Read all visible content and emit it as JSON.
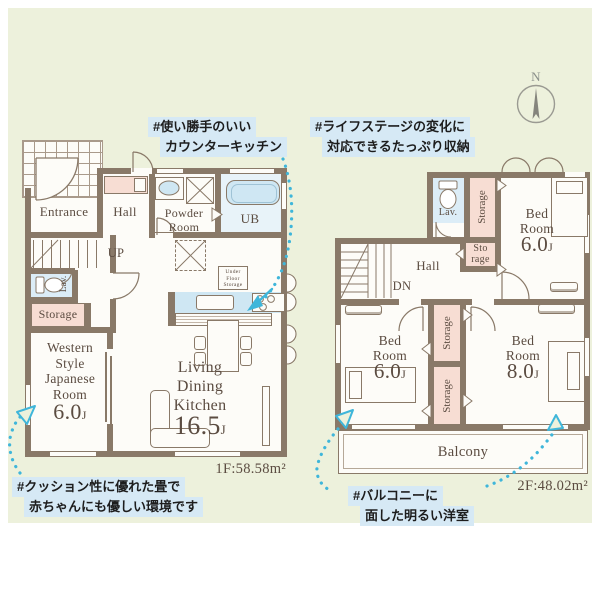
{
  "compass": {
    "label": "N"
  },
  "annotations": {
    "kitchen": [
      "#使い勝手のいい",
      "カウンターキッチン"
    ],
    "storage": [
      "#ライフステージの変化に",
      "対応できるたっぷり収納"
    ],
    "tatami": [
      "#クッション性に優れた畳で",
      "赤ちゃんにも優しい環境です"
    ],
    "balcony": [
      "#バルコニーに",
      "面した明るい洋室"
    ]
  },
  "floor1": {
    "area_label": "1F:58.58m²",
    "rooms": {
      "entrance": "Entrance",
      "hall": "Hall",
      "powder": [
        "Powder",
        "Room"
      ],
      "bath": "UB",
      "stairs": "UP",
      "lavatory": "Lav.",
      "storage": "Storage",
      "under_floor": "Under Floor Storage",
      "japanese": {
        "l1": "Western",
        "l2": "Style",
        "l3": "Japanese",
        "l4": "Room",
        "size": "6.0",
        "unit": "J"
      },
      "ldk": {
        "l1": "Living",
        "l2": "Dining",
        "l3": "Kitchen",
        "size": "16.5",
        "unit": "J"
      }
    }
  },
  "floor2": {
    "area_label": "2F:48.02m²",
    "rooms": {
      "lavatory": "Lav.",
      "storage_top": "Storage",
      "storage_small": [
        "Sto",
        "rage"
      ],
      "hall": "Hall",
      "stairs": "DN",
      "bed_top": {
        "l1": "Bed",
        "l2": "Room",
        "size": "6.0",
        "unit": "J"
      },
      "bed_left": {
        "l1": "Bed",
        "l2": "Room",
        "size": "6.0",
        "unit": "J"
      },
      "bed_right": {
        "l1": "Bed",
        "l2": "Room",
        "size": "8.0",
        "unit": "J"
      },
      "storage_mid1": "Storage",
      "storage_mid2": "Storage",
      "balcony": "Balcony"
    }
  },
  "colors": {
    "background": "#edf1dc",
    "wall": "#897968",
    "accent_pink": "#f7ddd3",
    "accent_blue": "#cfe7f3",
    "arrow_cyan": "#3fb6da",
    "annotation_bg": "#d6e9f5",
    "label_text": "#5b4c41"
  }
}
